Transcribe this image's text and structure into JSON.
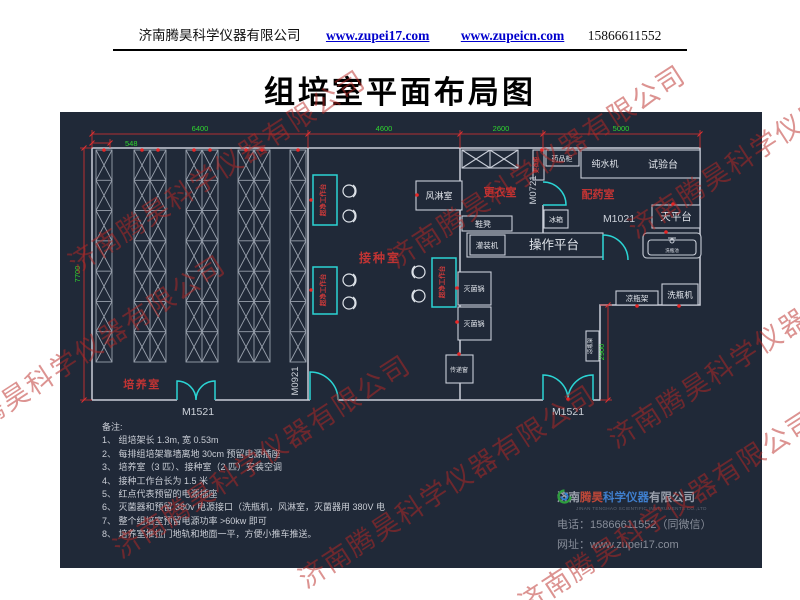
{
  "header": {
    "company": "济南腾昊科学仪器有限公司",
    "link1": "www.zupei17.com",
    "link2": "www.zupeicn.com",
    "phone": "15866611552"
  },
  "title": "组培室平面布局图",
  "watermark": "济南腾昊科学仪器有限公司",
  "plan": {
    "rooms": {
      "culture": "培养室",
      "inoculation": "接种室",
      "changing": "更衣室",
      "dispensing": "配药室"
    },
    "doors": {
      "m1521_left": "M1521",
      "m1521_right": "M1521",
      "m0921": "M0921",
      "m0721": "M0721",
      "m1021": "M1021"
    },
    "dims": {
      "d548": "548",
      "d6400": "6400",
      "d4600": "4600",
      "d2600": "2600",
      "d5000": "5000",
      "d7700": "7700",
      "d2900": "2900"
    },
    "equipment": {
      "clean_bench": "超净工作台",
      "air_shower": "风淋室",
      "wardrobe": "更衣柜",
      "medicine_cabinet": "药品柜",
      "water_purifier": "纯水机",
      "test_bench": "试验台",
      "shoe_bench": "鞋凳",
      "fridge": "冰箱",
      "balance_table": "天平台",
      "filling_machine": "灌装机",
      "operation_platform": "操作平台",
      "sink": "洗瓶池",
      "sterilizer_1": "灭菌锅",
      "sterilizer_2": "灭菌锅",
      "pass_window": "传递窗",
      "cooling_rack_h": "凉瓶架",
      "bottle_washer": "洗瓶机",
      "cooling_rack_v": "凉瓶架"
    }
  },
  "notes": {
    "title": "备注:",
    "items": [
      "1、 组培架长 1.3m, 宽 0.53m",
      "2、 每排组培架靠墙离地 30cm 预留电源插座",
      "3、 培养室（3 匹）、接种室（2 匹）安装空调",
      "4、 接种工作台长为 1.5 米",
      "5、 红点代表预留的电源插座",
      "6、 灭菌器和预留 380v 电源接口（洗瓶机，风淋室，灭菌器用 380V 电",
      "7、 整个组培室预留电源功率 >60kw 即可",
      "8、 培养室推拉门地轨和地面一平，方便小推车推送。"
    ]
  },
  "footer": {
    "company_cn_1": "济南",
    "company_cn_2": "腾昊",
    "company_cn_3": "科学仪器",
    "company_cn_4": "有限公司",
    "company_en": "JINAN TENGHAO SCIENTIFIC INSTRUMENTS CO.,LTD",
    "phone_label": "电话：",
    "phone": "15866611552（同微信）",
    "web_label": "网址：",
    "web": "www.zupei17.com"
  }
}
